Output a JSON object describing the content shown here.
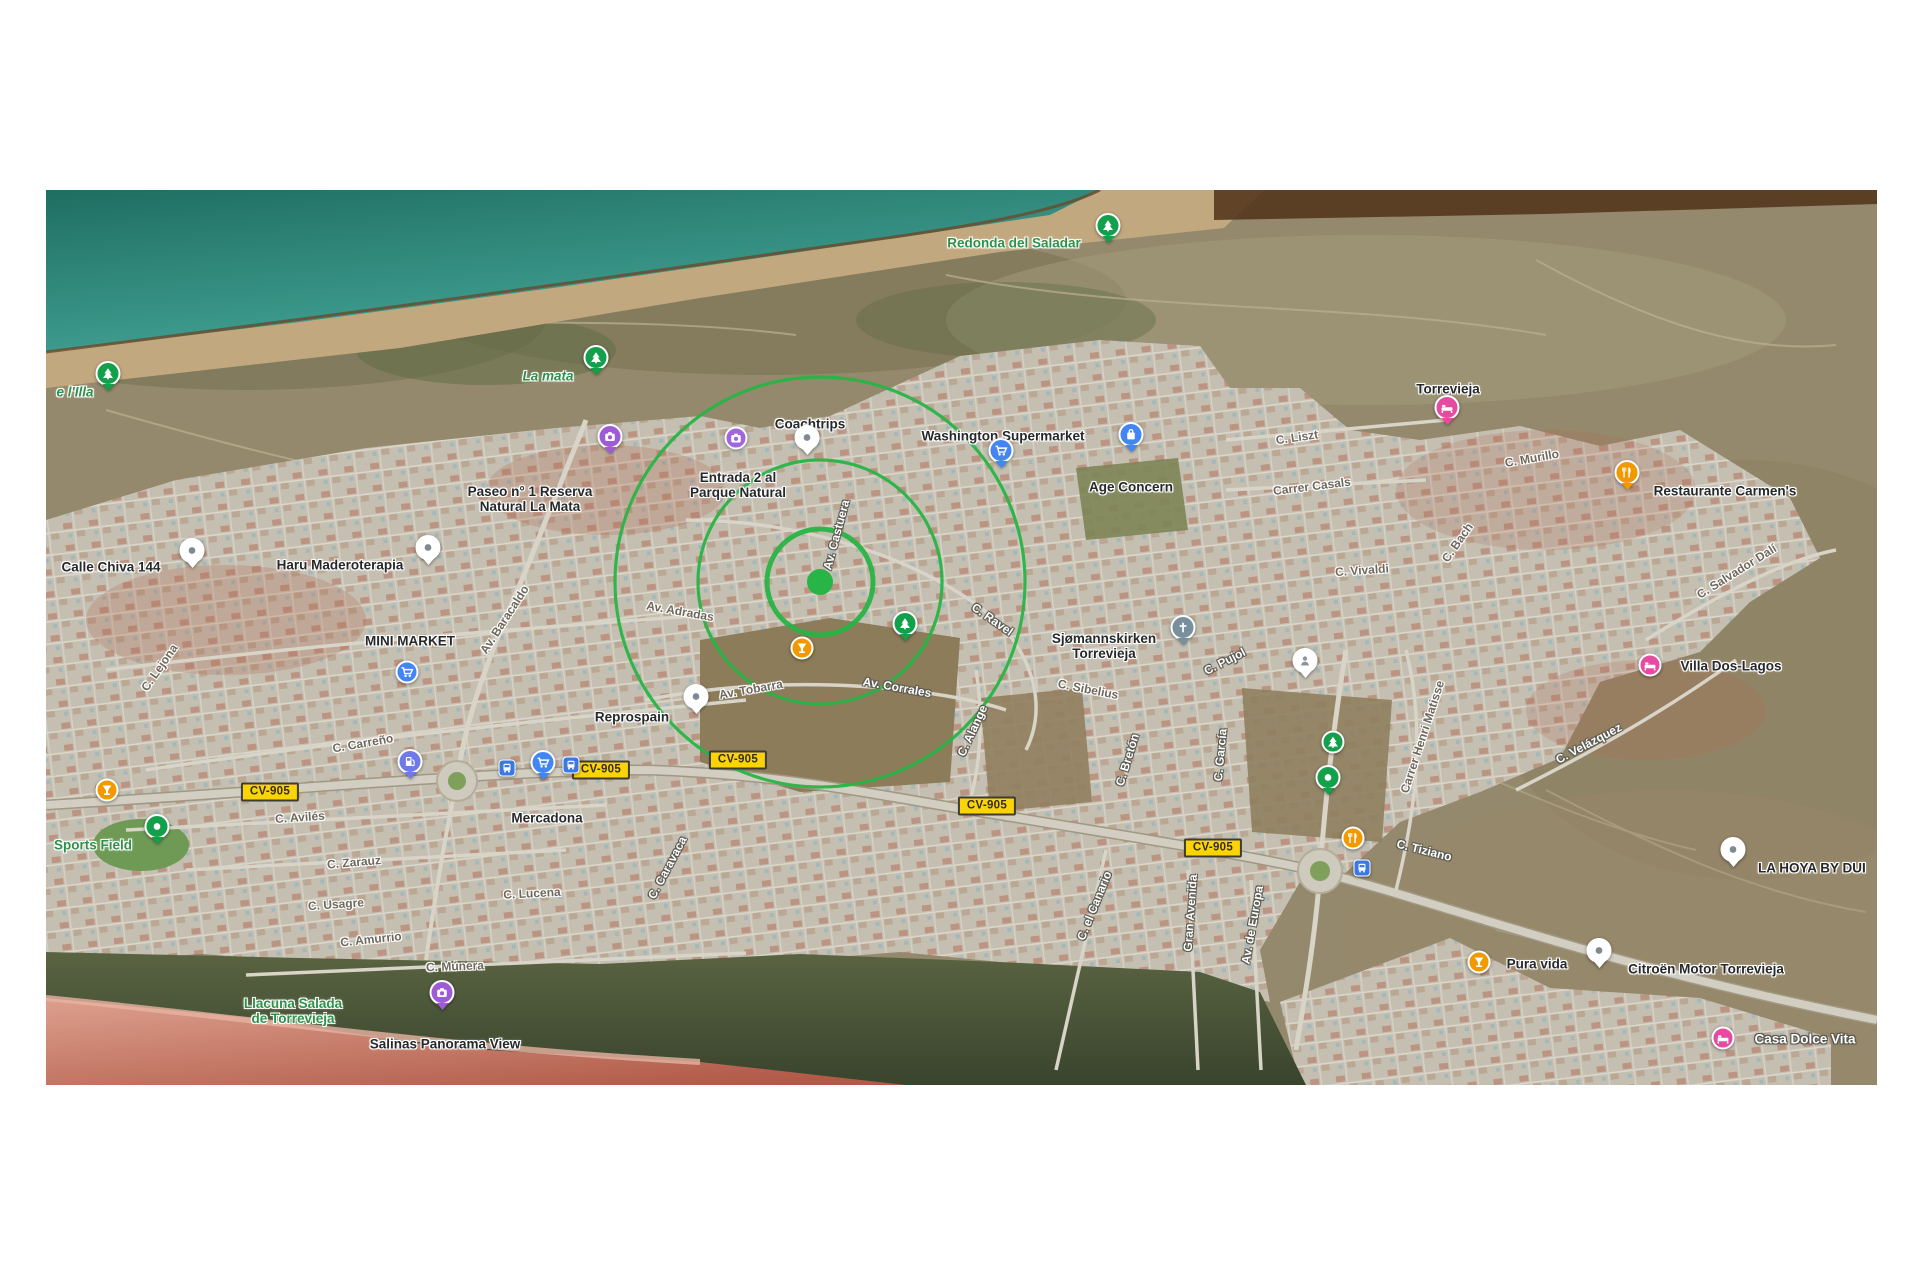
{
  "map": {
    "description": "Satellite map of La Mata - Torrevieja with POI pins, road labels, CV-905 badges and radius circles",
    "colors": {
      "sea": "#2a8d80",
      "sand": "#c2a87e",
      "scrub": "#94896c",
      "urban": "#c5bfb2",
      "salt_lake": "#cf8271",
      "circle_green": "#28b446",
      "badge_yellow": "#fcd305",
      "pin_blue": "#4285f4",
      "pin_orange": "#f29900",
      "pin_magenta": "#e54ba0",
      "pin_purple": "#9f5bd6",
      "pin_green": "#12a04b",
      "pin_slate": "#78909c"
    },
    "circles": {
      "cx": 774,
      "cy": 392,
      "dot_radius": 13,
      "radii": [
        53,
        122,
        205
      ],
      "stroke_widths": [
        5,
        3.2,
        3.2
      ],
      "color": "#28b446"
    },
    "route_badges": [
      {
        "label": "CV-905",
        "x": 224,
        "y": 602
      },
      {
        "label": "CV-905",
        "x": 555,
        "y": 580
      },
      {
        "label": "CV-905",
        "x": 692,
        "y": 570
      },
      {
        "label": "CV-905",
        "x": 941,
        "y": 616
      },
      {
        "label": "CV-905",
        "x": 1167,
        "y": 658
      }
    ],
    "labels": [
      {
        "kind": "poi",
        "style": "poi-green",
        "lines": [
          "Redonda del Saladar"
        ],
        "x": 968,
        "y": 53
      },
      {
        "kind": "poi",
        "style": "poi-green-italic",
        "lines": [
          "La mata"
        ],
        "x": 502,
        "y": 186
      },
      {
        "kind": "poi",
        "style": "poi-green-italic",
        "lines": [
          "e l'Illa"
        ],
        "x": 29,
        "y": 202
      },
      {
        "kind": "poi",
        "style": "poi",
        "lines": [
          "Coachtrips"
        ],
        "x": 764,
        "y": 234
      },
      {
        "kind": "poi",
        "style": "poi",
        "lines": [
          "Washington Supermarket"
        ],
        "x": 957,
        "y": 246
      },
      {
        "kind": "poi",
        "style": "poi",
        "lines": [
          "Age Concern"
        ],
        "x": 1085,
        "y": 297
      },
      {
        "kind": "poi",
        "style": "poi",
        "lines": [
          "Entrada 2 al",
          "Parque Natural"
        ],
        "x": 692,
        "y": 295
      },
      {
        "kind": "poi",
        "style": "poi",
        "lines": [
          "Paseo n° 1 Reserva",
          "Natural La Mata"
        ],
        "x": 484,
        "y": 309
      },
      {
        "kind": "poi",
        "style": "poi",
        "lines": [
          "Torrevieja"
        ],
        "x": 1402,
        "y": 199
      },
      {
        "kind": "poi",
        "style": "poi",
        "lines": [
          "Restaurante Carmen's"
        ],
        "x": 1679,
        "y": 301
      },
      {
        "kind": "poi",
        "style": "poi",
        "lines": [
          "Calle Chiva 144"
        ],
        "x": 65,
        "y": 377
      },
      {
        "kind": "poi",
        "style": "poi",
        "lines": [
          "Haru Maderoterapia"
        ],
        "x": 294,
        "y": 375
      },
      {
        "kind": "poi",
        "style": "poi",
        "lines": [
          "MINI MARKET"
        ],
        "x": 364,
        "y": 451
      },
      {
        "kind": "poi",
        "style": "poi",
        "lines": [
          "Sjømannskirken",
          "Torrevieja"
        ],
        "x": 1058,
        "y": 456
      },
      {
        "kind": "poi",
        "style": "poi",
        "lines": [
          "Villa Dos-Lagos"
        ],
        "x": 1685,
        "y": 476
      },
      {
        "kind": "poi",
        "style": "poi",
        "lines": [
          "Reprospain"
        ],
        "x": 586,
        "y": 527
      },
      {
        "kind": "poi",
        "style": "poi",
        "lines": [
          "Mercadona"
        ],
        "x": 501,
        "y": 628
      },
      {
        "kind": "poi",
        "style": "poi-green",
        "lines": [
          "Sports Field"
        ],
        "x": 47,
        "y": 655
      },
      {
        "kind": "poi",
        "style": "poi",
        "lines": [
          "LA HOYA BY DUI"
        ],
        "x": 1712,
        "y": 678,
        "align": "left"
      },
      {
        "kind": "poi",
        "style": "poi",
        "lines": [
          "Pura vida"
        ],
        "x": 1491,
        "y": 774
      },
      {
        "kind": "poi",
        "style": "poi",
        "lines": [
          "Citroën Motor Torrevieja"
        ],
        "x": 1660,
        "y": 779
      },
      {
        "kind": "poi",
        "style": "poi-light",
        "lines": [
          "Casa Dolce Vita"
        ],
        "x": 1759,
        "y": 849
      },
      {
        "kind": "poi",
        "style": "poi-green",
        "lines": [
          "Llacuna Salada",
          "de Torrevieja"
        ],
        "x": 247,
        "y": 821
      },
      {
        "kind": "poi",
        "style": "poi",
        "lines": [
          "Salinas Panorama View"
        ],
        "x": 399,
        "y": 854
      },
      {
        "kind": "road",
        "style": "road-dark",
        "lines": [
          "C. Lejona"
        ],
        "x": 114,
        "y": 478,
        "rot": -55
      },
      {
        "kind": "road",
        "style": "road-dark",
        "lines": [
          "Av. Baracaldo"
        ],
        "x": 459,
        "y": 430,
        "rot": -57
      },
      {
        "kind": "road",
        "style": "road-dark",
        "lines": [
          "Av. Adradas"
        ],
        "x": 634,
        "y": 422,
        "rot": 10
      },
      {
        "kind": "road",
        "style": "road-light",
        "lines": [
          "Av. Castuera"
        ],
        "x": 791,
        "y": 345,
        "rot": -75
      },
      {
        "kind": "road",
        "style": "road-light",
        "lines": [
          "C. Ravel"
        ],
        "x": 946,
        "y": 430,
        "rot": 35
      },
      {
        "kind": "road",
        "style": "road-dark",
        "lines": [
          "C. Carreño"
        ],
        "x": 317,
        "y": 554,
        "rot": -10
      },
      {
        "kind": "road",
        "style": "road-dark",
        "lines": [
          "C. Avilés"
        ],
        "x": 254,
        "y": 628,
        "rot": -4
      },
      {
        "kind": "road",
        "style": "road-dark",
        "lines": [
          "C. Zarauz"
        ],
        "x": 308,
        "y": 673,
        "rot": -5
      },
      {
        "kind": "road",
        "style": "road-dark",
        "lines": [
          "C. Usagre"
        ],
        "x": 290,
        "y": 715,
        "rot": -4
      },
      {
        "kind": "road",
        "style": "road-dark",
        "lines": [
          "C. Amurrio"
        ],
        "x": 325,
        "y": 750,
        "rot": -6
      },
      {
        "kind": "road",
        "style": "road-dark",
        "lines": [
          "C. Lucena"
        ],
        "x": 486,
        "y": 704,
        "rot": -3
      },
      {
        "kind": "road",
        "style": "road-dark",
        "lines": [
          "C. Múnera"
        ],
        "x": 409,
        "y": 777,
        "rot": -2
      },
      {
        "kind": "road",
        "style": "road-light",
        "lines": [
          "C. Caravaca"
        ],
        "x": 622,
        "y": 678,
        "rot": -62
      },
      {
        "kind": "road",
        "style": "road-dark",
        "lines": [
          "Av. Tobarra"
        ],
        "x": 705,
        "y": 500,
        "rot": -10
      },
      {
        "kind": "road",
        "style": "road-light",
        "lines": [
          "Av. Corrales"
        ],
        "x": 851,
        "y": 498,
        "rot": 10
      },
      {
        "kind": "road",
        "style": "road-light",
        "lines": [
          "C. Alange"
        ],
        "x": 927,
        "y": 541,
        "rot": -65
      },
      {
        "kind": "road",
        "style": "road-dark",
        "lines": [
          "C. Sibelius"
        ],
        "x": 1042,
        "y": 500,
        "rot": 11
      },
      {
        "kind": "road",
        "style": "road-light",
        "lines": [
          "C. Pujol"
        ],
        "x": 1179,
        "y": 472,
        "rot": -27
      },
      {
        "kind": "road",
        "style": "road-light",
        "lines": [
          "C. Bretón"
        ],
        "x": 1082,
        "y": 570,
        "rot": -73
      },
      {
        "kind": "road",
        "style": "road-light",
        "lines": [
          "C. García"
        ],
        "x": 1175,
        "y": 565,
        "rot": -85
      },
      {
        "kind": "road",
        "style": "road-light",
        "lines": [
          "C. el Canario"
        ],
        "x": 1049,
        "y": 716,
        "rot": -68
      },
      {
        "kind": "road",
        "style": "road-light",
        "lines": [
          "Gran Avenida"
        ],
        "x": 1145,
        "y": 723,
        "rot": -86
      },
      {
        "kind": "road",
        "style": "road-light",
        "lines": [
          "Av. de Europa"
        ],
        "x": 1207,
        "y": 735,
        "rot": -80
      },
      {
        "kind": "road",
        "style": "road-light",
        "lines": [
          "C. Tiziano"
        ],
        "x": 1378,
        "y": 661,
        "rot": 14
      },
      {
        "kind": "road",
        "style": "road-dark",
        "lines": [
          "C. Liszt"
        ],
        "x": 1251,
        "y": 248,
        "rot": -8
      },
      {
        "kind": "road",
        "style": "road-dark",
        "lines": [
          "Carrer Casals"
        ],
        "x": 1266,
        "y": 297,
        "rot": -7
      },
      {
        "kind": "road",
        "style": "road-dark",
        "lines": [
          "C. Murillo"
        ],
        "x": 1486,
        "y": 269,
        "rot": -10
      },
      {
        "kind": "road",
        "style": "road-dark",
        "lines": [
          "C. Bach"
        ],
        "x": 1412,
        "y": 353,
        "rot": -55
      },
      {
        "kind": "road",
        "style": "road-dark",
        "lines": [
          "C. Vivaldi"
        ],
        "x": 1316,
        "y": 381,
        "rot": -4
      },
      {
        "kind": "road",
        "style": "road-dark",
        "lines": [
          "C. Salvador Dalí"
        ],
        "x": 1691,
        "y": 382,
        "rot": -32
      },
      {
        "kind": "road",
        "style": "road-dark",
        "lines": [
          "Carrer Henri Matisse"
        ],
        "x": 1377,
        "y": 547,
        "rot": -72
      },
      {
        "kind": "road",
        "style": "road-light",
        "lines": [
          "C. Velázquez"
        ],
        "x": 1543,
        "y": 554,
        "rot": -28
      }
    ],
    "pins": [
      {
        "icon": "tree",
        "shape": "pin",
        "color": "#12a04b",
        "x": 1062,
        "y": 53
      },
      {
        "icon": "tree",
        "shape": "pin",
        "color": "#12a04b",
        "x": 550,
        "y": 185
      },
      {
        "icon": "tree",
        "shape": "pin",
        "color": "#12a04b",
        "x": 62,
        "y": 201
      },
      {
        "icon": "camera",
        "shape": "pin",
        "color": "#9f5bd6",
        "x": 564,
        "y": 264
      },
      {
        "icon": "camera",
        "shape": "circle",
        "color": "#a166dd",
        "x": 690,
        "y": 248
      },
      {
        "icon": "dot",
        "shape": "pin",
        "color": "#ffffff",
        "x": 761,
        "y": 265
      },
      {
        "icon": "cart",
        "shape": "pin",
        "color": "#4285f4",
        "x": 955,
        "y": 278
      },
      {
        "icon": "bag",
        "shape": "pin",
        "color": "#4285f4",
        "x": 1085,
        "y": 262
      },
      {
        "icon": "bed",
        "shape": "pin",
        "color": "#e54ba0",
        "x": 1401,
        "y": 235
      },
      {
        "icon": "restaurant",
        "shape": "pin",
        "color": "#f29900",
        "x": 1581,
        "y": 300
      },
      {
        "icon": "dot",
        "shape": "pin",
        "color": "#ffffff",
        "x": 146,
        "y": 378
      },
      {
        "icon": "dot",
        "shape": "pin",
        "color": "#ffffff",
        "x": 382,
        "y": 375
      },
      {
        "icon": "cart",
        "shape": "circle",
        "color": "#4285f4",
        "x": 361,
        "y": 482
      },
      {
        "icon": "church",
        "shape": "pin",
        "color": "#78909c",
        "x": 1137,
        "y": 455
      },
      {
        "icon": "bed",
        "shape": "circle",
        "color": "#e54ba0",
        "x": 1604,
        "y": 475
      },
      {
        "icon": "dot",
        "shape": "pin",
        "color": "#ffffff",
        "x": 650,
        "y": 524
      },
      {
        "icon": "cart",
        "shape": "pin",
        "color": "#4285f4",
        "x": 497,
        "y": 590
      },
      {
        "icon": "dot-green",
        "shape": "pin",
        "color": "#12a04b",
        "x": 111,
        "y": 654
      },
      {
        "icon": "dot",
        "shape": "pin",
        "color": "#ffffff",
        "x": 1687,
        "y": 677
      },
      {
        "icon": "cocktail",
        "shape": "circle",
        "color": "#f29900",
        "x": 1433,
        "y": 772
      },
      {
        "icon": "dot",
        "shape": "pin",
        "color": "#ffffff",
        "x": 1553,
        "y": 778
      },
      {
        "icon": "bed",
        "shape": "circle",
        "color": "#e54ba0",
        "x": 1677,
        "y": 848
      },
      {
        "icon": "camera",
        "shape": "pin",
        "color": "#9f5bd6",
        "x": 396,
        "y": 820
      },
      {
        "icon": "cocktail",
        "shape": "circle",
        "color": "#f29900",
        "x": 756,
        "y": 458
      },
      {
        "icon": "cocktail",
        "shape": "circle",
        "color": "#f29900",
        "x": 61,
        "y": 600
      },
      {
        "icon": "tree",
        "shape": "pin",
        "color": "#12a04b",
        "x": 859,
        "y": 451
      },
      {
        "icon": "person",
        "shape": "pin",
        "color": "#ffffff",
        "x": 1259,
        "y": 488
      },
      {
        "icon": "tree",
        "shape": "circle",
        "color": "#12a04b",
        "x": 1287,
        "y": 552
      },
      {
        "icon": "dot-green",
        "shape": "pin",
        "color": "#12a04b",
        "x": 1282,
        "y": 605
      },
      {
        "icon": "restaurant",
        "shape": "circle",
        "color": "#f29900",
        "x": 1307,
        "y": 648
      },
      {
        "icon": "bus",
        "shape": "square",
        "color": "#3b78e7",
        "x": 461,
        "y": 578
      },
      {
        "icon": "bus",
        "shape": "square",
        "color": "#3b78e7",
        "x": 525,
        "y": 575
      },
      {
        "icon": "bus",
        "shape": "square",
        "color": "#3b78e7",
        "x": 1316,
        "y": 678
      },
      {
        "icon": "fuel",
        "shape": "pin",
        "color": "#6f79e8",
        "x": 364,
        "y": 589
      }
    ]
  }
}
